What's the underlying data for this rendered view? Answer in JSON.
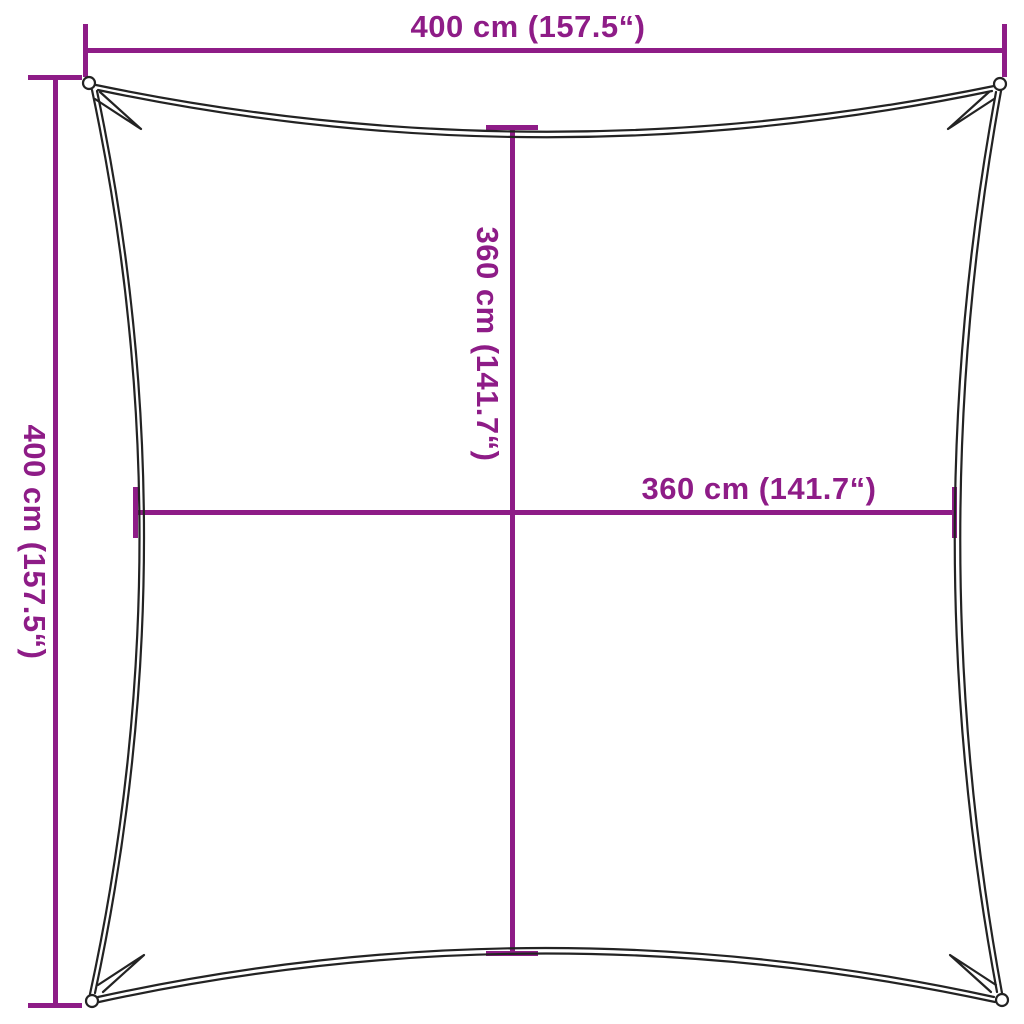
{
  "diagram": {
    "type": "product-dimension-diagram",
    "subject": "square shade sail with concave edges, corner eyelets and dimension lines"
  },
  "colors": {
    "dimension": "#8E1C87",
    "sail_line": "#232323",
    "background": "#FFFFFF"
  },
  "dimensions": {
    "outer_width": {
      "label": "400 cm (157.5“)",
      "value_cm": 400,
      "value_in": 157.5,
      "position": "top"
    },
    "outer_height": {
      "label": "400 cm (157.5“)",
      "value_cm": 400,
      "value_in": 157.5,
      "position": "left"
    },
    "inner_height": {
      "label": "360 cm (141.7“)",
      "value_cm": 360,
      "value_in": 141.7,
      "position": "center-vertical"
    },
    "inner_width": {
      "label": "360 cm (141.7“)",
      "value_cm": 360,
      "value_in": 141.7,
      "position": "center-horizontal"
    }
  }
}
